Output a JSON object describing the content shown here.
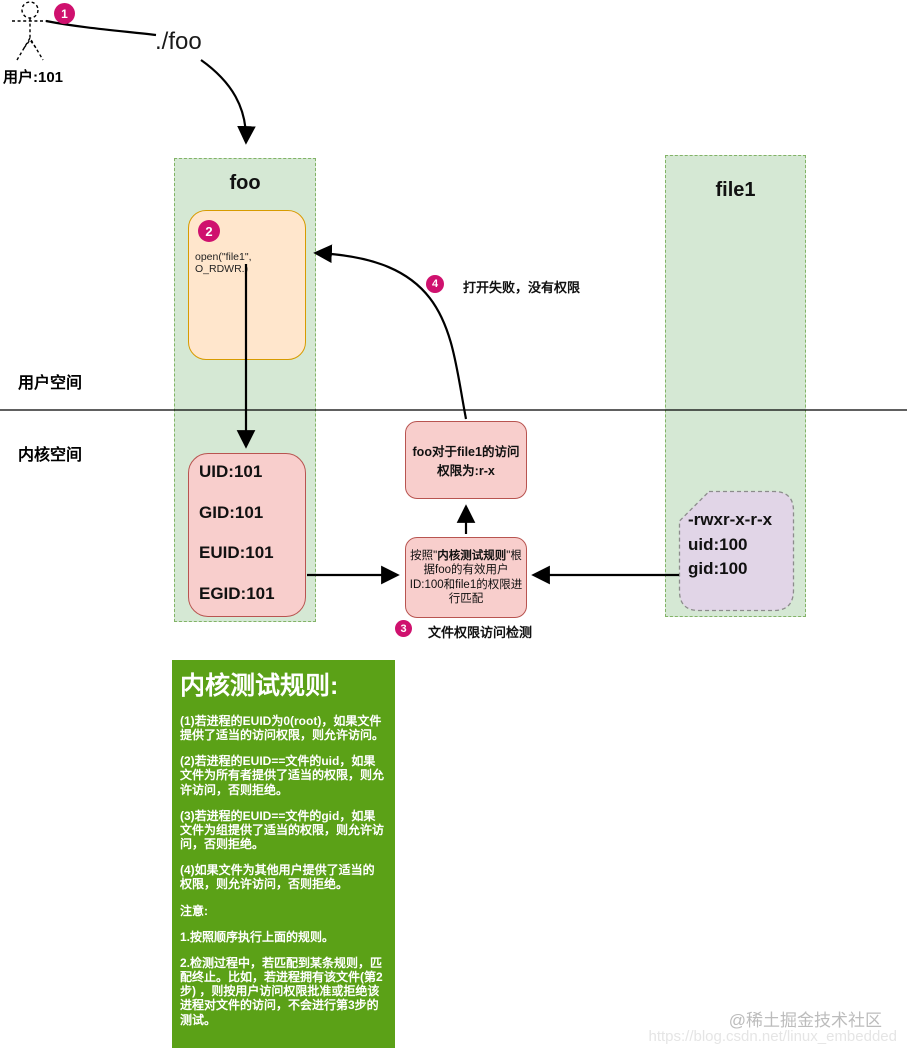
{
  "diagram": {
    "badges": {
      "b1": "1",
      "b2": "2",
      "b3": "3",
      "b4": "4"
    },
    "actor": {
      "label": "用户:101"
    },
    "edge1_label": "./foo",
    "foo_box": {
      "title": "foo"
    },
    "open_box": {
      "code": "open(\"file1\", O_RDWR.)"
    },
    "cred_box": {
      "lines": [
        "UID:101",
        "GID:101",
        "EUID:101",
        "EGID:101"
      ]
    },
    "file1_box": {
      "title": "file1"
    },
    "perm_box": {
      "lines": [
        "-rwxr-x-r-x",
        "uid:100",
        "gid:100"
      ]
    },
    "access_box": {
      "text": "foo对于file1的访问权限为:r-x"
    },
    "match_box": {
      "prefix": "按照\"",
      "bold": "内核测试规则",
      "suffix": "\"根据foo的有效用户ID:100和file1的权限进行匹配"
    },
    "step3_label": "文件权限访问检测",
    "step4_label": "打开失败，没有权限",
    "space_labels": {
      "user": "用户空间",
      "kernel": "内核空间"
    },
    "rules_box": {
      "title": "内核测试规则:",
      "rules": [
        "(1)若进程的EUID为0(root)，如果文件提供了适当的访问权限，则允许访问。",
        "(2)若进程的EUID==文件的uid，如果文件为所有者提供了适当的权限，则允许访问，否则拒绝。",
        "(3)若进程的EUID==文件的gid，如果文件为组提供了适当的权限，则允许访问，否则拒绝。",
        "(4)如果文件为其他用户提供了适当的权限，则允许访问，否则拒绝。"
      ],
      "note_title": "注意:",
      "notes": [
        "1.按照顺序执行上面的规则。",
        "2.检测过程中，若匹配到某条规则，匹配终止。比如，若进程拥有该文件(第2步) ，则按用户访问权限批准或拒绝该进程对文件的访问，不会进行第3步的测试。"
      ]
    },
    "watermark": {
      "line1": "@稀土掘金技术社区",
      "line2": "https://blog.csdn.net/linux_embedded"
    },
    "colors": {
      "accent_pink": "#cf116e",
      "zone_green_fill": "#d5e8d4",
      "zone_green_border": "#82b366",
      "orange_fill": "#ffe6cc",
      "orange_border": "#d79b00",
      "pink_fill": "#f8cecc",
      "pink_border": "#b85450",
      "purple_fill": "#e1d5e7",
      "rules_green": "#5ba117"
    }
  }
}
